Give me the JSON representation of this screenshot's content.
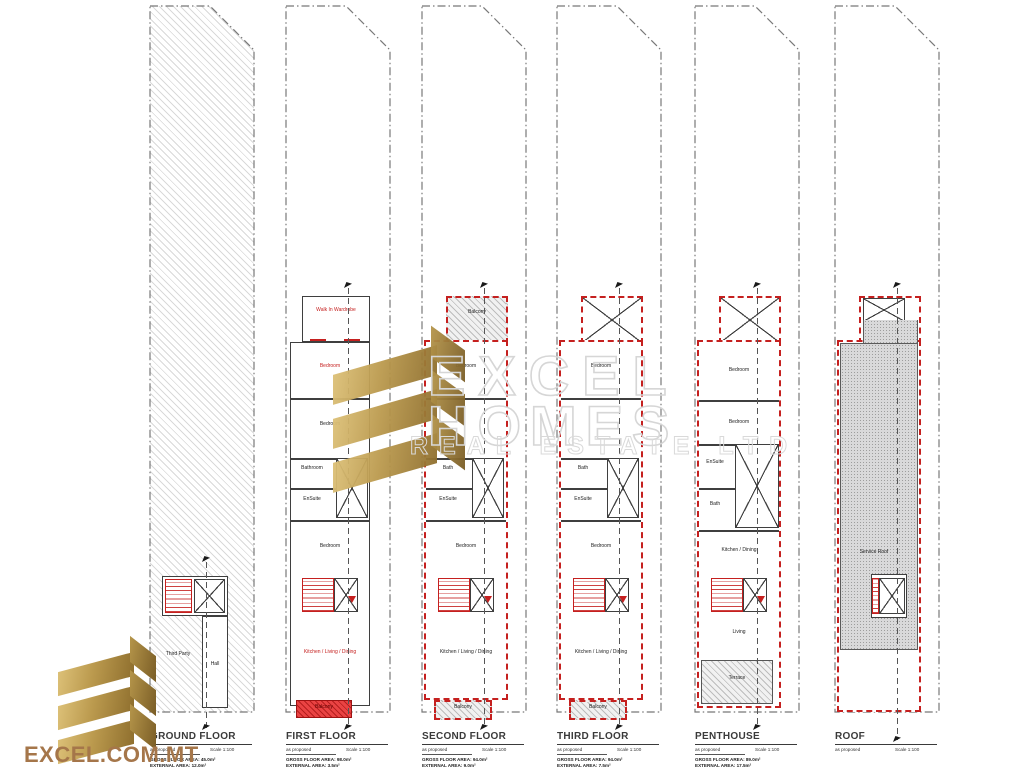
{
  "brand": {
    "site": "EXCEL.COM.MT"
  },
  "watermark": {
    "line1": "EXCEL",
    "line2": "HOMES",
    "line3": "REAL ESTATE LTD"
  },
  "colors": {
    "red": "#c5201f",
    "gold": "#b89146",
    "bronze": "#a5764a"
  },
  "plans": [
    {
      "title": "GROUND FLOOR",
      "note": "as proposed",
      "scale": "Scale 1:100",
      "area1": "GROSS FLOOR AREA: 45.0m²",
      "area2": "EXTERNAL AREA: 12.0m²",
      "rooms": {
        "third_party": "Third Party",
        "hall": "Hall"
      }
    },
    {
      "title": "FIRST FLOOR",
      "note": "as proposed",
      "scale": "Scale 1:100",
      "area1": "GROSS FLOOR AREA: 98.0m²",
      "area2": "EXTERNAL AREA: 3.5m²",
      "rooms": {
        "wardrobe": "Walk In Wardrobe",
        "bedroom1": "Bedroom",
        "bedroom2": "Bedroom",
        "bathroom": "Bathroom",
        "ensuite": "EnSuite",
        "bedroom3": "Bedroom",
        "kitchen": "Kitchen / Living / Dining",
        "balcony": "Balcony"
      }
    },
    {
      "title": "SECOND FLOOR",
      "note": "as proposed",
      "scale": "Scale 1:100",
      "area1": "GROSS FLOOR AREA: 94.0m²",
      "area2": "EXTERNAL AREA: 9.0m²",
      "rooms": {
        "balcony_top": "Balcony",
        "bedroom1": "Bedroom",
        "bath": "Bath",
        "ensuite": "EnSuite",
        "bedroom2": "Bedroom",
        "kitchen": "Kitchen / Living / Dining",
        "balcony": "Balcony"
      }
    },
    {
      "title": "THIRD FLOOR",
      "note": "as proposed",
      "scale": "Scale 1:100",
      "area1": "GROSS FLOOR AREA: 94.0m²",
      "area2": "EXTERNAL AREA: 7.5m²",
      "rooms": {
        "bedroom1": "Bedroom",
        "bath": "Bath",
        "ensuite": "EnSuite",
        "bedroom2": "Bedroom",
        "kitchen": "Kitchen / Living / Dining",
        "balcony": "Balcony"
      }
    },
    {
      "title": "PENTHOUSE",
      "note": "as proposed",
      "scale": "Scale 1:100",
      "area1": "GROSS FLOOR AREA: 89.0m²",
      "area2": "EXTERNAL AREA: 17.5m²",
      "rooms": {
        "bedroom1": "Bedroom",
        "bedroom2": "Bedroom",
        "ensuite": "EnSuite",
        "bath": "Bath",
        "kitchen": "Kitchen / Dining",
        "living": "Living",
        "terrace": "Terrace"
      }
    },
    {
      "title": "ROOF",
      "note": "as proposed",
      "scale": "Scale 1:100",
      "rooms": {
        "service": "Service Roof"
      }
    }
  ]
}
